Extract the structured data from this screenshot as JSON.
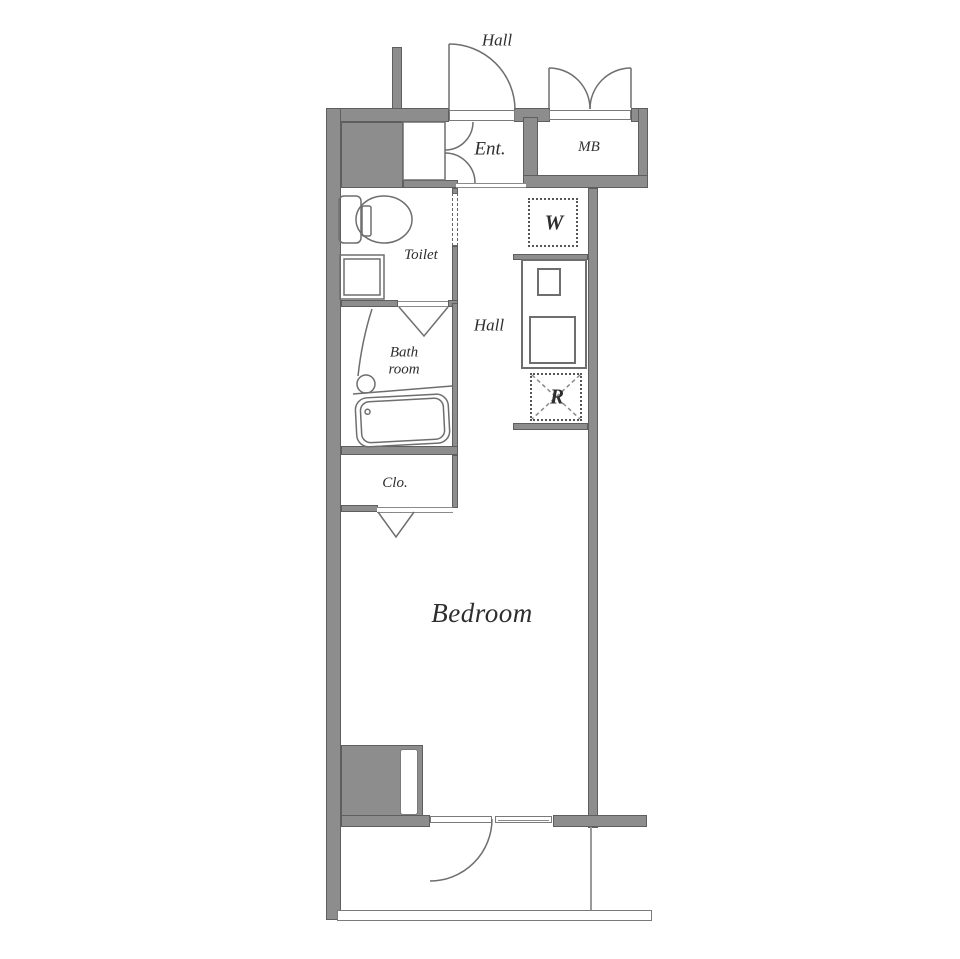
{
  "labels": {
    "hall_top": "Hall",
    "entrance": "Ent.",
    "meter_box": "MB",
    "washing_machine": "W",
    "toilet": "Toilet",
    "hall": "Hall",
    "bathroom_line1": "Bath",
    "bathroom_line2": "room",
    "refrigerator": "R",
    "closet": "Clo.",
    "bedroom": "Bedroom"
  },
  "colors": {
    "wall_fill": "#8d8d8d",
    "wall_edge": "#5e5e5e",
    "fixture_line": "#6e6e6e",
    "text": "#2e2e2e",
    "background": "#ffffff"
  }
}
